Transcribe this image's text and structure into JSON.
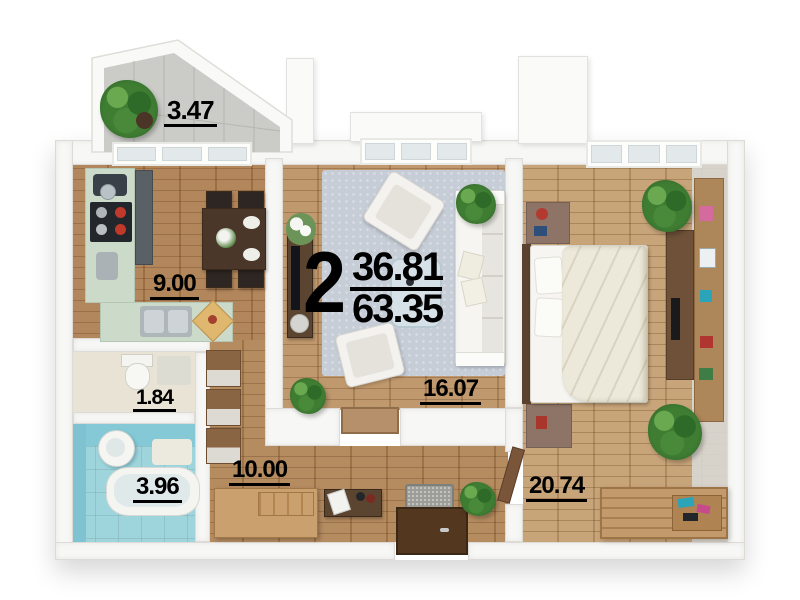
{
  "summary": {
    "rooms_count": "2",
    "living_area": "36.81",
    "total_area": "63.35"
  },
  "areas": {
    "balcony": "3.47",
    "kitchen": "9.00",
    "toilet": "1.84",
    "bathroom": "3.96",
    "hallway": "10.00",
    "living_room": "16.07",
    "bedroom": "20.74"
  },
  "colors": {
    "wood_floor": "#b5895c",
    "rug": "#c6cdd7",
    "bathroom_tile": "#9ed5dc",
    "kitchen_counter": "#ccdbc9",
    "wall": "#f7f7f5",
    "label_text": "#000000"
  }
}
